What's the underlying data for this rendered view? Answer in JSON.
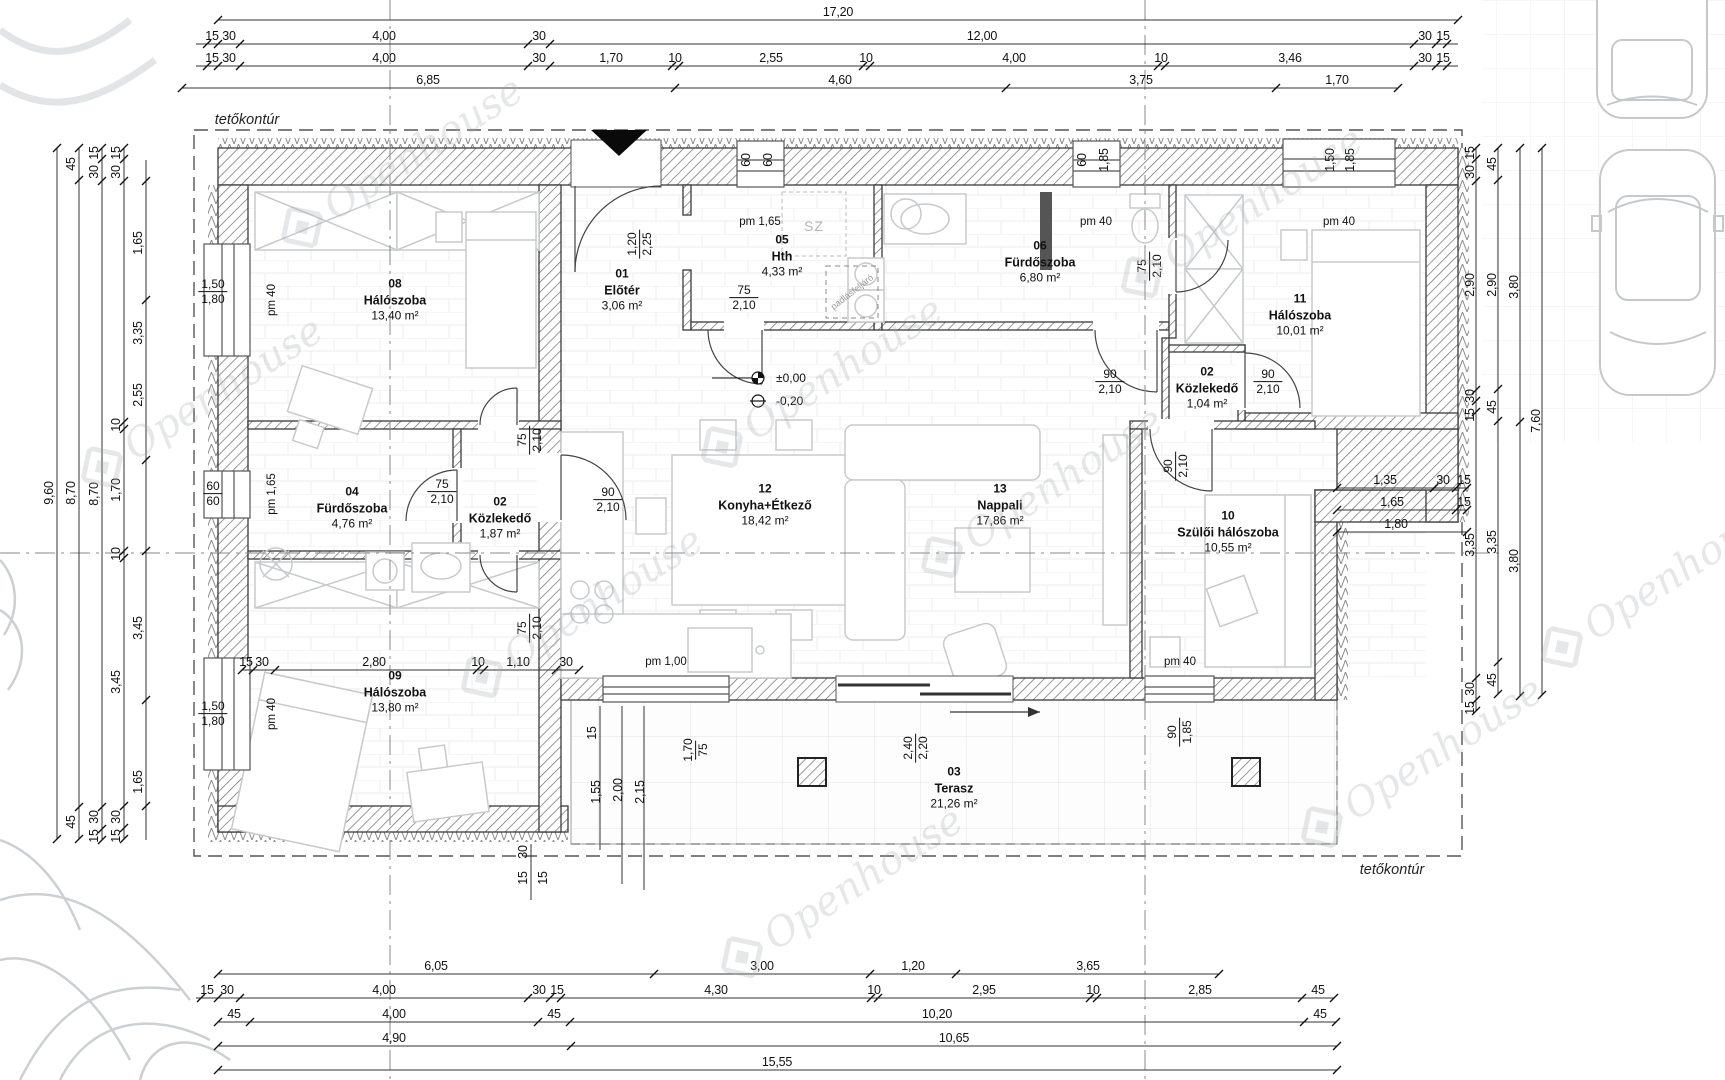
{
  "meta": {
    "watermark": "Openhouse"
  },
  "labels": {
    "roof_top": "tetőkontúr",
    "roof_bottom": "tetőkontúr",
    "closet": "SZ",
    "attic": "padlásfeljáró",
    "level_zero": "±0,00",
    "level_minus": "-0,20"
  },
  "rooms": [
    {
      "num": "08",
      "name": "Hálószoba",
      "area": "13,40 m²"
    },
    {
      "num": "01",
      "name": "Előtér",
      "area": "3,06 m²"
    },
    {
      "num": "05",
      "name": "Hth",
      "area": "4,33 m²"
    },
    {
      "num": "06",
      "name": "Fürdőszoba",
      "area": "6,80 m²"
    },
    {
      "num": "02",
      "name": "Közlekedő",
      "area": "1,04 m²"
    },
    {
      "num": "11",
      "name": "Hálószoba",
      "area": "10,01 m²"
    },
    {
      "num": "04",
      "name": "Fürdőszoba",
      "area": "4,76 m²"
    },
    {
      "num": "02",
      "name": "Közlekedő",
      "area": "1,87 m²"
    },
    {
      "num": "12",
      "name": "Konyha+Étkező",
      "area": "18,42 m²"
    },
    {
      "num": "13",
      "name": "Nappali",
      "area": "17,86 m²"
    },
    {
      "num": "10",
      "name": "Szülői hálószoba",
      "area": "10,55 m²"
    },
    {
      "num": "09",
      "name": "Hálószoba",
      "area": "13,80 m²"
    },
    {
      "num": "03",
      "name": "Terasz",
      "area": "21,26 m²"
    }
  ],
  "dims": {
    "top_row1": [
      "17,20"
    ],
    "top_row2": [
      "15",
      "30",
      "4,00",
      "30",
      "12,00",
      "30",
      "15"
    ],
    "top_row3": [
      "15",
      "30",
      "4,00",
      "30",
      "1,70",
      "10",
      "2,55",
      "10",
      "4,00",
      "10",
      "3,46",
      "30",
      "15"
    ],
    "top_row4": [
      "6,85",
      "4,60",
      "3,75",
      "1,70"
    ],
    "bottom_row1": [
      "6,05",
      "3,00",
      "1,20",
      "3,65"
    ],
    "bottom_row2": [
      "15",
      "30",
      "4,00",
      "30",
      "15",
      "4,30",
      "10",
      "2,95",
      "10",
      "2,85",
      "45"
    ],
    "bottom_row3": [
      "45",
      "4,00",
      "45",
      "10,20",
      "45"
    ],
    "bottom_row4": [
      "4,90",
      "10,65"
    ],
    "bottom_row5": [
      "15,55"
    ],
    "left_total": [
      "9,60"
    ],
    "left_col2": [
      "45",
      "8,70",
      "45"
    ],
    "left_col3": [
      "15",
      "30",
      "8,70",
      "30",
      "15"
    ],
    "left_col4": [
      "15",
      "30",
      "10",
      "1,70",
      "10",
      "3,45",
      "30",
      "15"
    ],
    "left_col5": [
      "1,65",
      "3,35",
      "2,55",
      "3,45",
      "1,65"
    ],
    "right_col1": [
      "15",
      "30",
      "2,90",
      "30",
      "15",
      "3,35",
      "30",
      "15"
    ],
    "right_col2": [
      "45",
      "2,90",
      "45",
      "3,35",
      "45"
    ],
    "right_col3": [
      "3,80",
      "3,80"
    ],
    "right_col4": [
      "7,60"
    ],
    "notch_r1": [
      "1,35",
      "30",
      "15"
    ],
    "notch_r2": [
      "1,65",
      "15"
    ],
    "notch_r3": [
      "1,80"
    ],
    "room09_chain": [
      "15",
      "30",
      "2,80",
      "10",
      "1,10",
      "30"
    ],
    "terrace_v": [
      "15",
      "1,55",
      "2,00",
      "2,15"
    ],
    "terrace_edge": [
      "30",
      "15",
      "15"
    ]
  },
  "openings": {
    "win08": {
      "pm": "pm 40",
      "a": "1,50",
      "b": "1,80"
    },
    "win04": {
      "pm": "pm 1,65",
      "a": "60",
      "b": "60"
    },
    "win09": {
      "pm": "pm 40",
      "a": "1,50",
      "b": "1,80"
    },
    "win05": {
      "pm": "pm 1,65",
      "a": "60",
      "b": "60"
    },
    "win06": {
      "pm": "pm 40",
      "a": "60",
      "b": "1,85"
    },
    "win11": {
      "pm": "pm 40",
      "a": "1,50",
      "b": "1,85"
    },
    "win12": {
      "pm": "pm 1,00",
      "a": "1,70",
      "b": "75"
    },
    "win10": {
      "pm": "pm 40",
      "a": "90",
      "b": "1,85"
    },
    "door_entry": {
      "a": "1,20",
      "b": "2,25"
    },
    "door_hth": {
      "a": "75",
      "b": "2,10"
    },
    "door_bath06": {
      "a": "75",
      "b": "2,10"
    },
    "door_hall_l": {
      "a": "90",
      "b": "2,10"
    },
    "door_hall_r": {
      "a": "90",
      "b": "2,10"
    },
    "door_corr_top": {
      "a": "75",
      "b": "2,10"
    },
    "door_bath04": {
      "a": "75",
      "b": "2,10"
    },
    "door_kitchen": {
      "a": "90",
      "b": "2,10"
    },
    "door_corr_bot": {
      "a": "75",
      "b": "2,10"
    },
    "door_room10": {
      "a": "90",
      "b": "2,10"
    },
    "door_terrace": {
      "a": "2,40",
      "b": "2,20"
    }
  }
}
